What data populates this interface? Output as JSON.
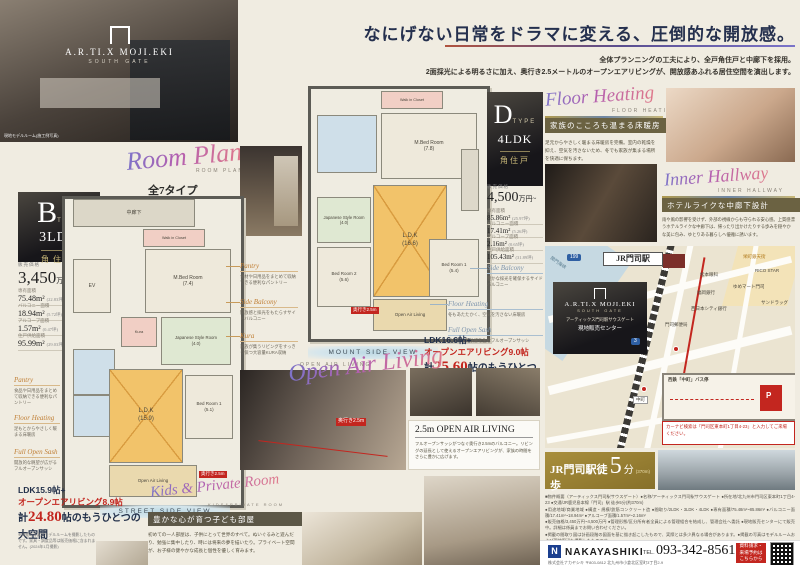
{
  "hero": {
    "photo_caption": "現地モデルルーム(施工例写真)",
    "logo_top": "A.R.TI.X MOJI.EKI",
    "logo_sub": "SOUTH GATE"
  },
  "headline": {
    "title": "なにげない日常をドラマに変える、圧倒的な開放感。",
    "sub1": "全体プランニングの工夫により、全戸角住戸と中廊下を採用。",
    "sub2": "2面採光による明るさに加え、奥行き2.5メートルのオープンエアリビングが、開放感あふれる居住空間を演出します。"
  },
  "room_plan": {
    "script": "Room Plan",
    "caps": "ROOM PLAN",
    "line1": "全7タイプ",
    "line2": "2LDK / 3LDK / 4LDK",
    "line3": "豊富なプランバリエーション"
  },
  "type_b": {
    "letter": "B",
    "type_word": "TYPE",
    "layout": "3LDK",
    "corner": "角住戸",
    "price_label": "販売価格",
    "price": "3,450",
    "price_unit": "万円~",
    "specs": [
      {
        "label": "専有面積",
        "value": "75.48m²",
        "tsubo": "(22.83坪)"
      },
      {
        "label": "バルコニー面積",
        "value": "18.94m²",
        "tsubo": "(5.72坪)"
      },
      {
        "label": "アルコーブ面積",
        "value": "1.57m²",
        "tsubo": "(0.47坪)"
      },
      {
        "label": "住戸供給面積",
        "value": "95.99m²",
        "tsubo": "(29.03坪)"
      }
    ],
    "view_caption": "STREET SIDE VIEW"
  },
  "plan_b": {
    "corridor": "中廊下",
    "ev": "EV",
    "wic": "Walk in Closet",
    "kura": "Kura",
    "mbed": "M.Bed Room\n(7.4)",
    "japanese": "Japanese Style Room\n(4.0)",
    "ldk": "L.D.K\n(15.9)",
    "bed1": "Bed Room 1\n(5.1)",
    "openair": "Open Air Living",
    "depth": "奥行き2.5m"
  },
  "type_d": {
    "letter": "D",
    "type_word": "TYPE",
    "layout": "4LDK",
    "corner": "角住戸",
    "price_label": "販売価格",
    "price": "4,500",
    "price_unit": "万円~",
    "specs": [
      {
        "label": "専有面積",
        "value": "85.86m²",
        "tsubo": "(25.97坪)"
      },
      {
        "label": "バルコニー面積",
        "value": "17.41m²",
        "tsubo": "(5.26坪)"
      },
      {
        "label": "アルコーブ面積",
        "value": "2.16m²",
        "tsubo": "(0.65坪)"
      },
      {
        "label": "住戸供給面積",
        "value": "105.43m²",
        "tsubo": "(31.89坪)"
      }
    ],
    "view_caption": "MOUNT SIDE VIEW"
  },
  "plan_d": {
    "wic": "Walk in Closet",
    "mbed": "M.Bed Room\n(7.8)",
    "japanese": "Japanese Style Room\n(4.0)",
    "bed2": "Bed Room 2\n(5.6)",
    "ldk": "L.D.K\n(16.6)",
    "bed1": "Bed Room 1\n(5.4)",
    "openair": "Open Air Living",
    "depth": "奥行き2.5m"
  },
  "annotations_mid": [
    {
      "title": "Pantry",
      "desc": "食材や日用品をまとめて収納できる便利なパントリー"
    },
    {
      "title": "Side Balcony",
      "desc": "開放感と採光をもたらすサイドバルコニー"
    },
    {
      "title": "Kura",
      "desc": "家族が集うリビングをすっきり保つ大容量KURA収納"
    }
  ],
  "annotations_left": [
    {
      "title": "Pantry",
      "desc": "食品や日用品をまとめて収納できる便利なパントリー"
    },
    {
      "title": "Floor Heating",
      "desc": "足もとからやさしく暖まる床暖房"
    },
    {
      "title": "Full Open Sash",
      "desc": "開放的な眺望が広がるフルオープンサッシ"
    }
  ],
  "annotations_d": [
    {
      "title": "Floor Heating",
      "desc": "冬もあたたかく、空気を汚さない床暖房"
    },
    {
      "title": "Full Open Sash",
      "desc": "圧倒的な開放感を生むフルオープンサッシ"
    }
  ],
  "annotation_side_balcony": {
    "title": "Side Balcony",
    "desc": "豊かな採光を確保するサイドバルコニー"
  },
  "open_air": {
    "script": "Open Air Living",
    "caps": "OPEN AIR LIVING",
    "stat_d": {
      "l1": "LDK16.6帖+",
      "l2": "オープンエアリビング9.0帖",
      "l3_head": "計",
      "l3_num": "25.60",
      "l3_tail": "帖のもうひとつの大空間"
    },
    "stat_b": {
      "l1": "LDK15.9帖+",
      "l2": "オープンエアリビング8.9帖",
      "l3_head": "計",
      "l3_num": "24.80",
      "l3_tail": "帖のもうひとつの大空間"
    },
    "box_title": "2.5m OPEN AIR LIVING",
    "box_text": "フルオープンサッシがつなぐ奥行き2.5mのバルコニー。リビングの延長として使えるオープンエアリビングが、家族の時間をさらに豊かに広げます。",
    "arrow_tag": "奥行き2.5m",
    "disclaimer": "※掲載の写真はモデルルームを撮影したものです。家具・調度品等は販売価格に含まれません。(2024年1月撮影)"
  },
  "kids": {
    "script": "Kids & Private Room",
    "caps": "KIDS&PRIVATE ROOM",
    "heading": "豊かな心が育つ子ども部屋",
    "text": "初めての一人部屋は、子供にとって世界のすべて。ぬいぐるみと遊んだり、勉強に集中したり、時には将来の夢を描いたり。プライベート空間が、お子様の健やかな成長と個性を優しく育みます。"
  },
  "floor_heating": {
    "script": "Floor Heating",
    "caps": "FLOOR HEATING",
    "heading": "家族のこころも温まる床暖房",
    "text": "足元からやさしく暖まる床暖房を完備。室内の乾燥を抑え、空気を汚さないため、冬でも家族が集まる場所を快適に保ちます。"
  },
  "inner_hallway": {
    "script": "Inner Hallway",
    "caps": "INNER HALLWAY",
    "heading": "ホテルライクな中廊下設計",
    "text": "雨や風の影響を受けず、外部の視線からも守られる安心感。上質感漂うホテルライクな中廊下は、帰ったり出かけたりする歩みを穏やかな美に包み、ゆとりある暮らしへ優雅に誘います。"
  },
  "map": {
    "station": "JR門司駅",
    "logo_top": "A.R.TI.X MOJI.EKI",
    "logo_sub": "SOUTH GATE",
    "logo_line1": "アーティックス門司駅サウスゲート",
    "logo_line2": "現地販売センター",
    "labels": {
      "sea": "関門海峡",
      "post": "門司郵便局",
      "bank1": "西日本シティ銀行",
      "bank2": "福岡銀行",
      "eye": "松本眼科",
      "mart": "ゆめマート門司",
      "rico": "RICO STAR",
      "arcade": "栄町銀天街",
      "drug": "サンドラッグ",
      "route3": "3",
      "route199": "199",
      "nakamachi": "中町"
    },
    "inset_title": "西鉄「中町」バス停",
    "inset_p": "P",
    "nav_note": "カーナビ検索は「門司区東本町1丁目4-23」と入力してご来場ください。"
  },
  "access": {
    "title_head": "JR門司駅徒歩",
    "num": "5",
    "unit": "分",
    "dist": "(370m)",
    "sub": "JR「門司駅」→JR「小倉駅」 所要時間:約5分"
  },
  "legal": {
    "lines": [
      "■物件概要〈アーティックス門司駅サウスゲート〉●名称/アーティックス門司駅サウスゲート ●所在地/北九州市門司区東本町1丁目4-23 ●交通/JR鹿児島本線「門司」駅 徒歩5分(約370m)",
      "●用途地域/商業地域 ●構造・規模/鉄筋コンクリート造 ●間取り/2LDK・3LDK・4LDK ●専有面積/75.48m²~85.86m² ●バルコニー面積/17.41m²~18.94m² ●アルコーブ面積/1.57m²~2.16m²",
      "●販売価格/3,450万円~4,500万円 ●管理形態/区分所有者全員による管理組合を結成し、管理会社へ委託 ●現地販売センターにて販売中。詳細は係員までお問い合わせください。",
      "●掲載の間取り図は計画段階の図面を基に描き起こしたもので、実際とは多少異なる場合があります。●掲載の写真はモデルルームおよび現地周辺を撮影したものです。",
      "●徒歩分数は80m=1分として算出しています。●掲載の情報は作成時点のものであり、今後変更となる場合があります。あらかじめご了承ください。",
      "●お問い合わせ・資料請求は株式会社ナカヤシキまでお気軽にどうぞ。"
    ]
  },
  "footer": {
    "logo_n": "N",
    "brand": "NAKAYASHIKI",
    "tel_label": "TEL.",
    "tel": "093-342-8561",
    "cta": "資料請求・\n来場予約は\nこちらから",
    "address": "株式会社ナカヤシキ 〒803-0812 北九州市小倉北区室町3丁目2-9"
  }
}
